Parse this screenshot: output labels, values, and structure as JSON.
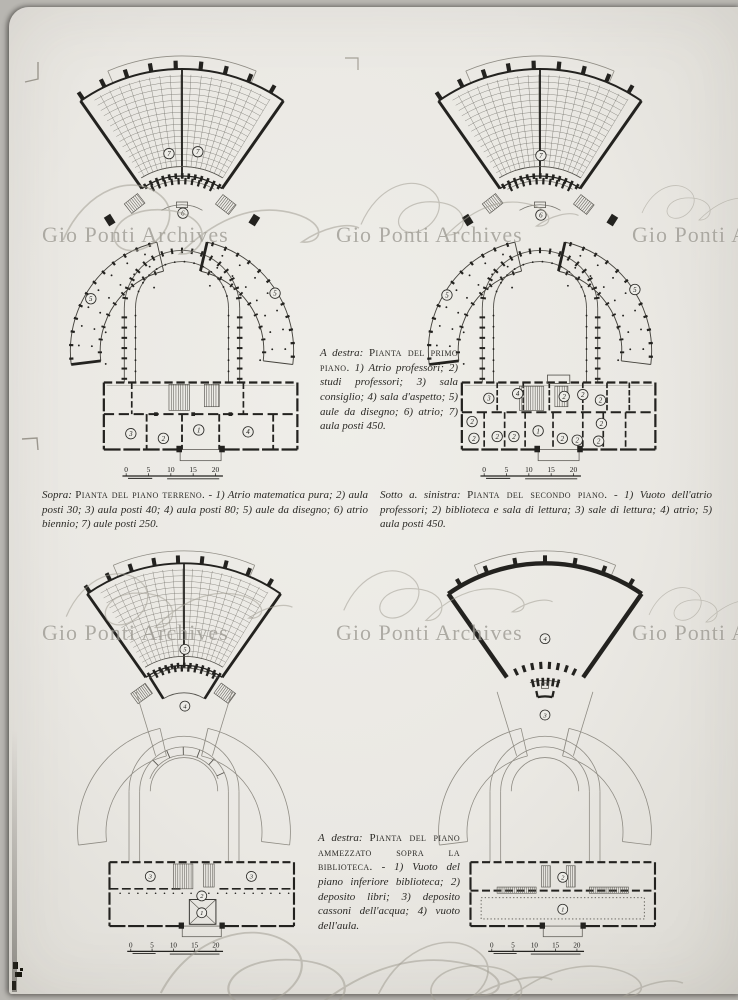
{
  "archive": {
    "watermark_text": "Gio Ponti Archives"
  },
  "captions": {
    "primo": {
      "intro": "A destra:",
      "title": "Pianta del primo piano.",
      "body": "1) Atrio professori; 2) studi professori; 3) sala consiglio; 4) sala d'aspetto; 5) aule da disegno; 6) atrio; 7) aula posti 450."
    },
    "terreno": {
      "intro": "Sopra:",
      "title": "Pianta del piano terreno.",
      "body": "- 1) Atrio matematica pura; 2) aula posti 30; 3) aula posti 40; 4) aula posti 80; 5) aule da disegno; 6) atrio biennio; 7) aule posti 250."
    },
    "secondo": {
      "intro": "Sotto a. sinistra:",
      "title": "Pianta del secondo piano.",
      "body": "- 1) Vuoto dell'atrio professori; 2) biblioteca e sala di lettura; 3) sale di lettura; 4) atrio; 5) aula posti 450."
    },
    "ammezzato": {
      "intro": "A destra:",
      "title": "Pianta del piano ammezzato sopra la biblioteca.",
      "body": "- 1) Vuoto del piano inferiore biblioteca; 2) deposito libri; 3) deposito cassoni dell'acqua; 4) vuoto dell'aula."
    }
  },
  "plans": {
    "terreno": {
      "title": "Pianta del piano terreno",
      "scale": [
        "0",
        "5",
        "10",
        "15",
        "20"
      ],
      "labels": [
        {
          "t": "7",
          "x": 136,
          "y": 106
        },
        {
          "t": "7",
          "x": 167,
          "y": 104
        },
        {
          "t": "6",
          "x": 151,
          "y": 170
        },
        {
          "t": "5",
          "x": 52,
          "y": 262
        },
        {
          "t": "5",
          "x": 250,
          "y": 256
        },
        {
          "t": "3",
          "x": 95,
          "y": 407
        },
        {
          "t": "2",
          "x": 130,
          "y": 412
        },
        {
          "t": "1",
          "x": 168,
          "y": 403
        },
        {
          "t": "4",
          "x": 221,
          "y": 405
        }
      ]
    },
    "primo": {
      "title": "Pianta del primo piano",
      "scale": [
        "0",
        "5",
        "10",
        "15",
        "20"
      ],
      "labels": [
        {
          "t": "7",
          "x": 151,
          "y": 108
        },
        {
          "t": "6",
          "x": 151,
          "y": 172
        },
        {
          "t": "5",
          "x": 50,
          "y": 258
        },
        {
          "t": "5",
          "x": 252,
          "y": 252
        },
        {
          "t": "3",
          "x": 95,
          "y": 369
        },
        {
          "t": "4",
          "x": 126,
          "y": 364
        },
        {
          "t": "2",
          "x": 176,
          "y": 367
        },
        {
          "t": "2",
          "x": 196,
          "y": 365
        },
        {
          "t": "2",
          "x": 215,
          "y": 371
        },
        {
          "t": "2",
          "x": 77,
          "y": 394
        },
        {
          "t": "2",
          "x": 79,
          "y": 412
        },
        {
          "t": "2",
          "x": 104,
          "y": 410
        },
        {
          "t": "2",
          "x": 122,
          "y": 410
        },
        {
          "t": "1",
          "x": 148,
          "y": 404
        },
        {
          "t": "2",
          "x": 174,
          "y": 412
        },
        {
          "t": "2",
          "x": 190,
          "y": 414
        },
        {
          "t": "2",
          "x": 213,
          "y": 415
        },
        {
          "t": "2",
          "x": 216,
          "y": 396
        }
      ]
    },
    "secondo": {
      "title": "Pianta del secondo piano",
      "scale": [
        "0",
        "5",
        "10",
        "15",
        "20"
      ],
      "labels": [
        {
          "t": "5",
          "x": 151,
          "y": 112
        },
        {
          "t": "4",
          "x": 151,
          "y": 176
        },
        {
          "t": "3",
          "x": 112,
          "y": 368
        },
        {
          "t": "3",
          "x": 226,
          "y": 368
        },
        {
          "t": "2",
          "x": 170,
          "y": 390
        },
        {
          "t": "1",
          "x": 170,
          "y": 409
        }
      ]
    },
    "ammezzato": {
      "title": "Pianta del piano ammezzato sopra la biblioteca",
      "scale": [
        "0",
        "5",
        "10",
        "15",
        "20"
      ],
      "labels": [
        {
          "t": "4",
          "x": 150,
          "y": 100
        },
        {
          "t": "3",
          "x": 150,
          "y": 186
        },
        {
          "t": "2",
          "x": 170,
          "y": 369
        },
        {
          "t": "1",
          "x": 170,
          "y": 405
        }
      ]
    }
  }
}
